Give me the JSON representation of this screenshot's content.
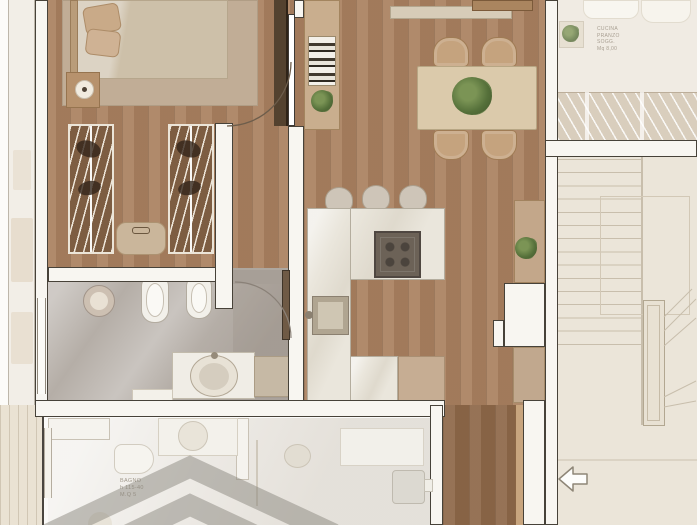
{
  "plan": {
    "title": "apartment-floor-plan-render",
    "labels": {
      "lower_bathroom": {
        "l1": "BAGNO",
        "l2": "h 115-40",
        "l3": "M.Q 5"
      },
      "adjacent_room": {
        "l1": "CUCINA",
        "l2": "PRANZO",
        "l3": "SOGG.",
        "l4": "Mq 8,00"
      }
    },
    "icons": [
      "entry-arrow-icon",
      "plant-icon",
      "lamp-icon",
      "door-swing-arc",
      "stair-treads",
      "watermark-chevron"
    ],
    "colors": {
      "wood_floor": "#aa8160",
      "wood_hallway": "#8e6849",
      "bathroom_marble": "#b5aea7",
      "counter_marble": "#eae6dc",
      "cabinet_tan": "#c6ad93",
      "wall_fill": "#f8f6f1",
      "wall_outline": "#474239",
      "wardrobe_wood": "#7d5d42",
      "plant_green": "#55703a",
      "stove_gray": "#6c6257",
      "faded_unit_floor": "#edeae5",
      "stairwell_floor": "#ebe5d9",
      "watermark_gray": "#87847b"
    }
  }
}
